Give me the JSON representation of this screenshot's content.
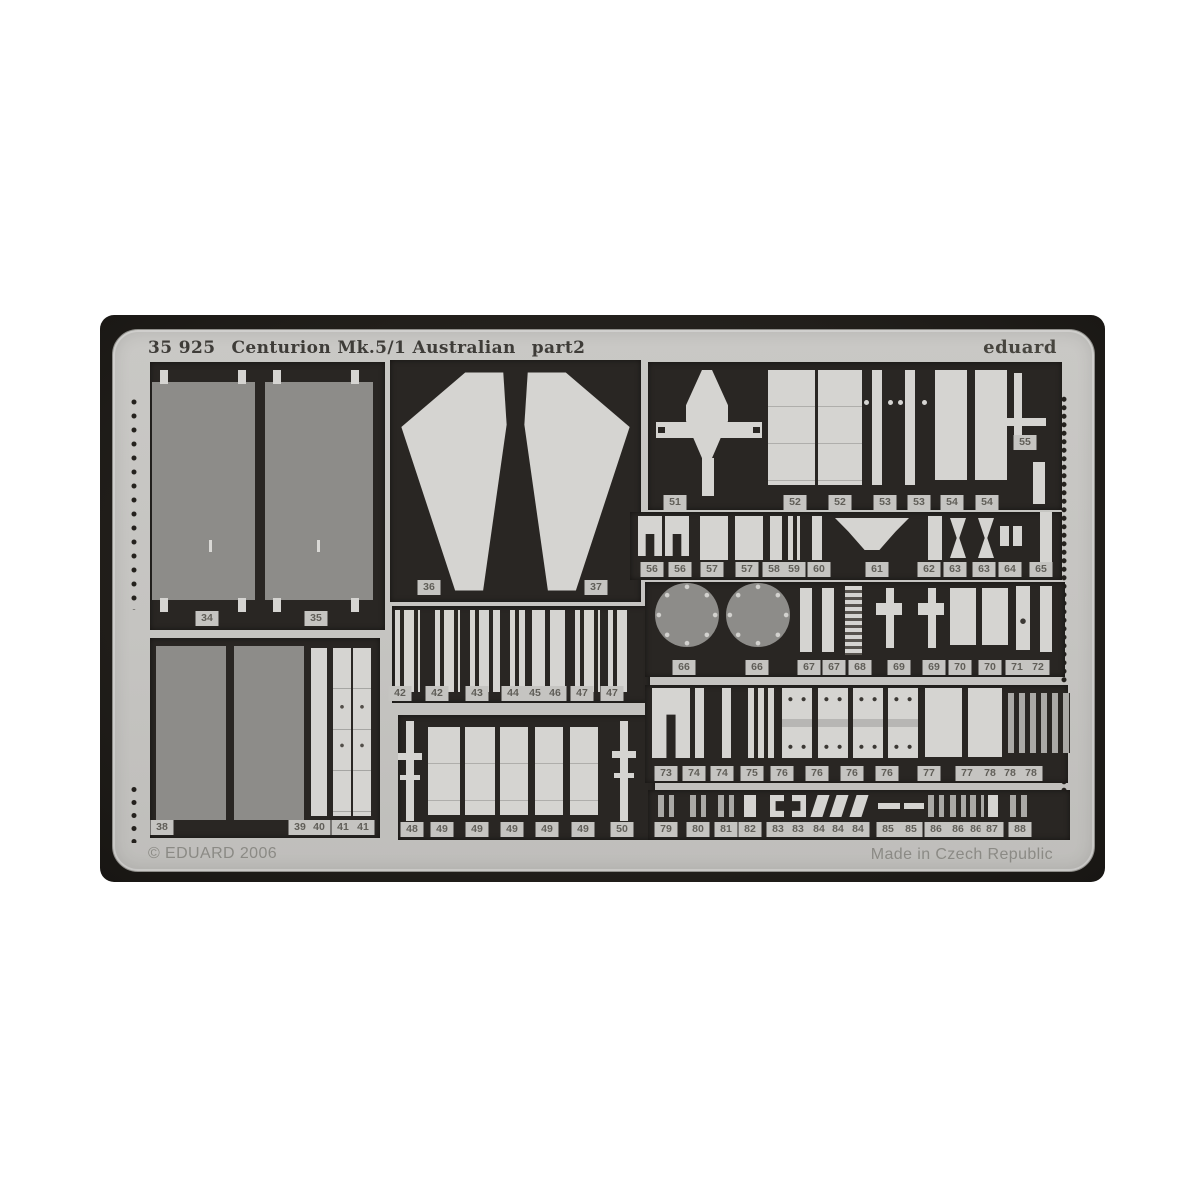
{
  "fret": {
    "title_code": "35 925",
    "title_name": "Centurion Mk.5/1 Australian",
    "title_part": "part2",
    "brand": "eduard",
    "copyright": "© EDUARD 2006",
    "made_in": "Made in Czech Republic",
    "colors": {
      "photo_background": "#221f1b",
      "sheet": "#c6c5c2",
      "cutout": "#292623",
      "part_light": "#d5d4d1",
      "part_etched": "#8d8c89",
      "label_text": "#605e58"
    },
    "labels": {
      "rowA": [
        "34",
        "35"
      ],
      "rowB": [
        "38",
        "39",
        "40",
        "41",
        "41"
      ],
      "rowC": [
        "36",
        "37"
      ],
      "rowD": [
        "42",
        "42",
        "43",
        "44",
        "45",
        "46",
        "47",
        "47"
      ],
      "rowE": [
        "48",
        "49",
        "49",
        "49",
        "49",
        "49",
        "50"
      ],
      "rowF": [
        "51",
        "52",
        "52",
        "53",
        "53",
        "54",
        "54"
      ],
      "label55": "55",
      "rowG": [
        "56",
        "56",
        "57",
        "57",
        "58",
        "59",
        "60",
        "61",
        "62",
        "63",
        "63",
        "64",
        "65"
      ],
      "rowH": [
        "66",
        "66",
        "67",
        "67",
        "68",
        "69",
        "69",
        "70",
        "70",
        "71",
        "72"
      ],
      "rowI": [
        "73",
        "74",
        "74",
        "75",
        "76",
        "76",
        "76",
        "76",
        "77",
        "77",
        "78",
        "78",
        "78"
      ],
      "rowJ": [
        "79",
        "80",
        "81",
        "82",
        "83",
        "83",
        "84",
        "84",
        "84",
        "85",
        "85",
        "86",
        "86",
        "86",
        "87",
        "88"
      ]
    }
  }
}
